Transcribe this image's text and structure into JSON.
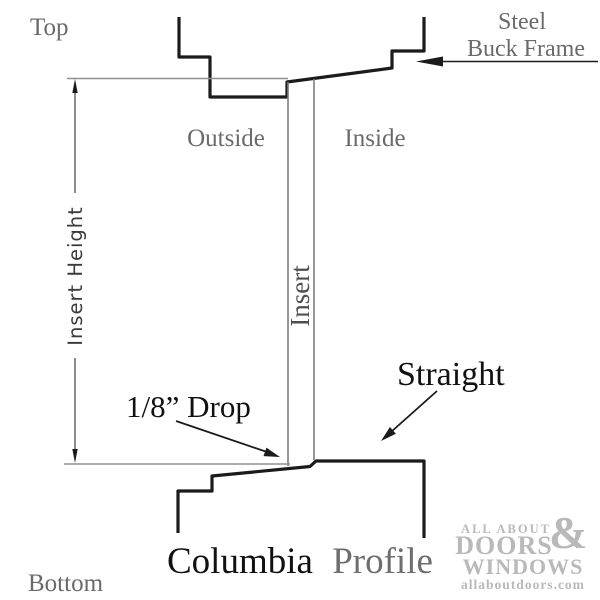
{
  "labels": {
    "top": "Top",
    "bottom": "Bottom",
    "outside": "Outside",
    "inside": "Inside",
    "insert": "Insert",
    "insert_height": "Insert Height",
    "steel_line1": "Steel",
    "steel_line2": "Buck Frame",
    "drop": "1/8” Drop",
    "straight": "Straight",
    "profile_name": "Columbia",
    "profile_word": "Profile"
  },
  "logo": {
    "line1": "ALL ABOUT",
    "ampersand": "&",
    "line2": "DOORS",
    "line3": "WINDOWS",
    "website": "allaboutdoors.com"
  },
  "colors": {
    "profile_black": "#1b1b1b",
    "gray_text": "#6a6a6a",
    "gray_line": "#8f8f8f",
    "insert_line": "#7d7d7d",
    "dim_line": "#3f3f3f",
    "insert_text": "#4f4f4f",
    "logo_gray": "#b9b9b9"
  }
}
